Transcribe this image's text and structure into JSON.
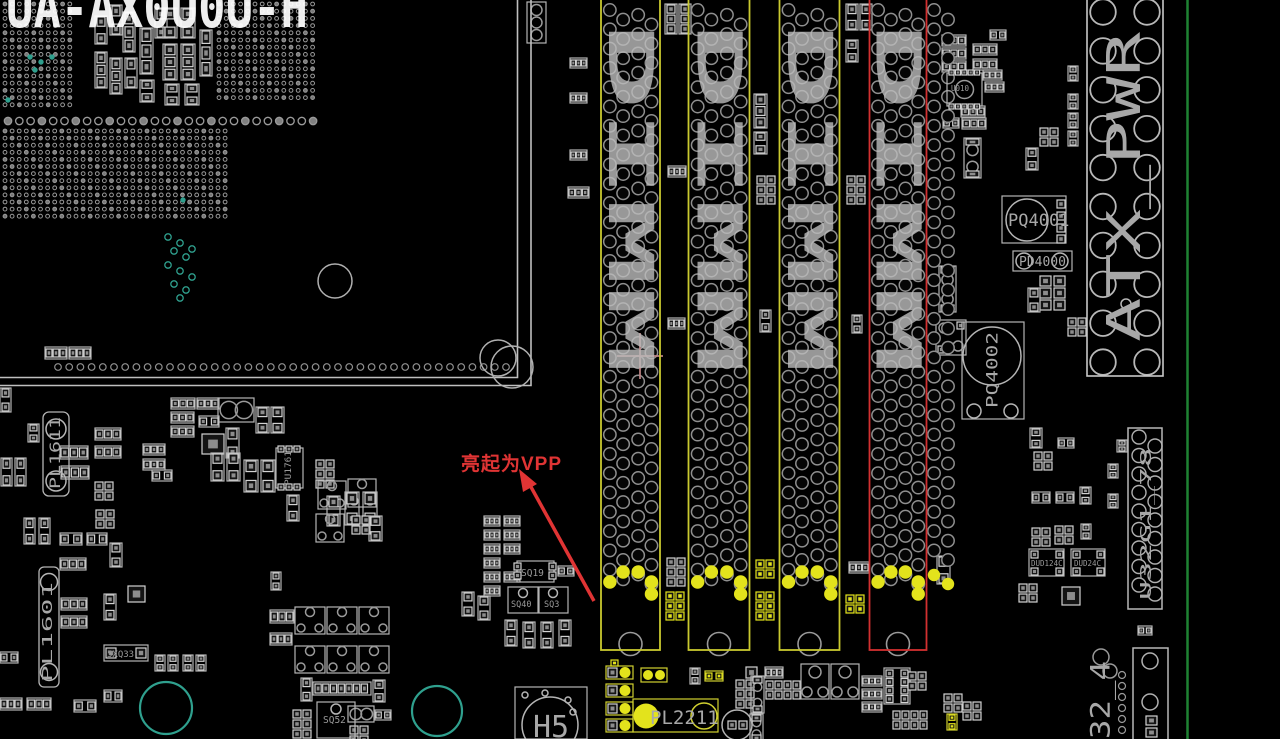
{
  "colors": {
    "background": "#000000",
    "silk": "#a8a8a8",
    "dimm_outline": "#c9c92f",
    "dimm_highlight_outline": "#d23030",
    "vpp_highlight": "#e3e31c",
    "annotation": "#e03434",
    "board_edge": "#1f8233",
    "teal": "#2fa08e",
    "pin_gray": "#8f8f8f"
  },
  "top_silk_text": {
    "text": "UA-AX0U0U-H"
  },
  "annotation": {
    "text": "亮起为VPP"
  },
  "dimm_slots": [
    {
      "label": "DIMM"
    },
    {
      "label": "DIMM"
    },
    {
      "label": "DIMM"
    },
    {
      "label": "DIMM"
    }
  ],
  "connectors": {
    "atx": {
      "label": "ATX_PWR"
    },
    "u32": {
      "label": "U32G1_78"
    },
    "usb32": {
      "label": "32_4"
    }
  },
  "refdes": {
    "pq4001": "PQ4001",
    "pd4000": "PD4000",
    "pq4002": "PQ4002",
    "pl1611": "PL1611",
    "pl1601": "PL1601",
    "pu1761": "PU1761",
    "sq19": "SQ19",
    "sq40": "SQ40",
    "sq3": "SQ3",
    "sq52": "SQ52",
    "sxq33": "5XQ33",
    "h5": "H5",
    "pl2211": "PL2211",
    "u010": "U010",
    "dud124c": "DUD124C",
    "dud24c": "DUD24C"
  }
}
